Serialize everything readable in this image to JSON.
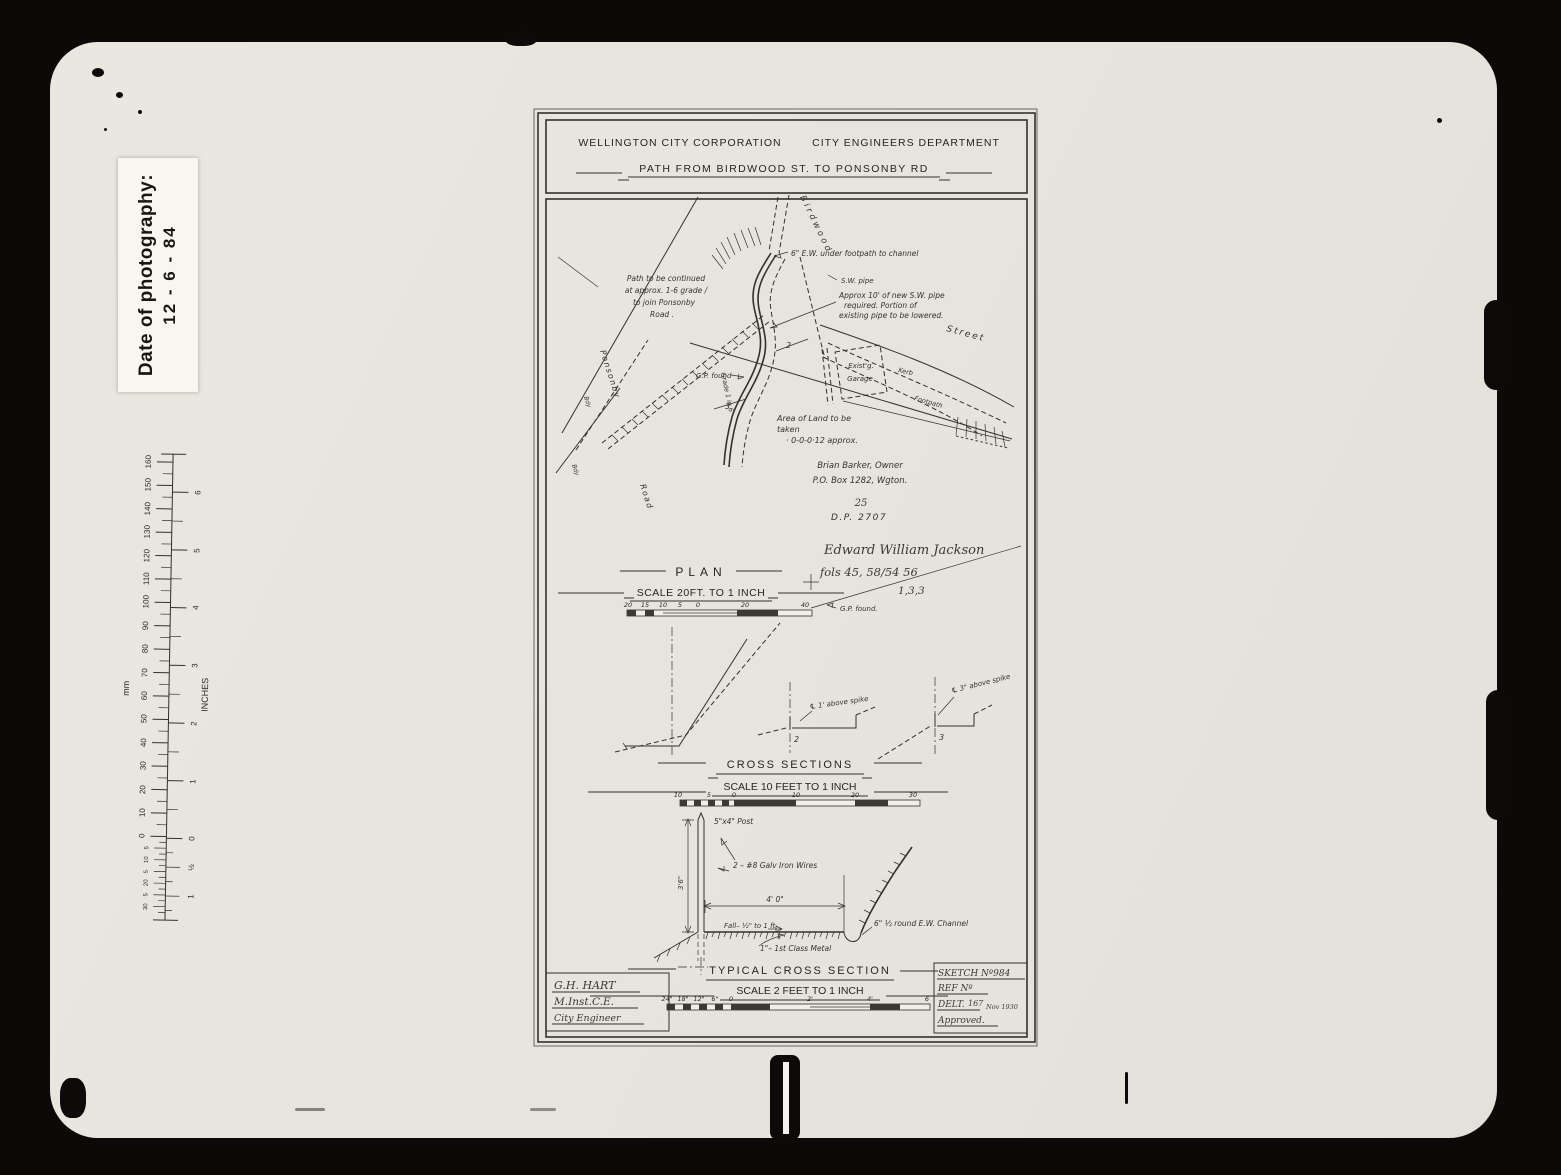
{
  "photo_label": {
    "title": "Date of photography:",
    "date": "12 - 6 - 84"
  },
  "ruler": {
    "unit_left": "mm",
    "unit_right": "INCHES",
    "mm": [
      "160",
      "150",
      "140",
      "130",
      "120",
      "110",
      "100",
      "90",
      "80",
      "70",
      "60",
      "50",
      "40",
      "30",
      "20",
      "10",
      "0"
    ],
    "mm_sub": [
      "5",
      "10",
      "5",
      "20",
      "5",
      "30"
    ],
    "inches": [
      "6",
      "5",
      "4",
      "3",
      "2",
      "1",
      "0"
    ],
    "inches_sub": [
      "½",
      "1"
    ]
  },
  "header": {
    "org": "WELLINGTON CITY CORPORATION",
    "dept": "CITY ENGINEERS DEPARTMENT",
    "title": "PATH FROM BIRDWOOD ST. TO PONSONBY RD"
  },
  "plan": {
    "title": "PLAN",
    "scale": "SCALE 20FT. TO 1 INCH",
    "ticks": [
      "20",
      "15",
      "10",
      "5",
      "0",
      "20",
      "40"
    ],
    "street_birdwood": "Birdwood",
    "street_label": "Street",
    "kerb": "Kerb",
    "footpath": "Footpath",
    "ponsonby": "Ponsonby",
    "road": "Road",
    "bdy1": "Bdy",
    "bdy2": "Bdy",
    "ew_note": "6\" E.W. under footpath to channel",
    "sw_pipe": "S.W. pipe",
    "pipe_note": [
      "Approx 10' of new S.W. pipe",
      "required.  Portion of",
      "existing pipe to be lowered."
    ],
    "path_note": [
      "Path to be continued",
      "at approx. 1-6 grade /",
      "to join Ponsonby",
      "Road ."
    ],
    "garage": [
      "Exist'g.",
      "Garage"
    ],
    "gp_found": "G.P. found",
    "grade": "Grade 1 in 6",
    "sec2": "2",
    "sec3": "3",
    "area_note": [
      "Area of Land to be",
      "taken",
      "· 0-0-0·12  approx."
    ],
    "owner": [
      "Brian  Barker, Owner",
      "P.O. Box 1282, Wgton."
    ],
    "lot": "25",
    "dp": "D.P. 2707",
    "hand": [
      "Edward William Jackson",
      "fols 45, 58/54 56",
      "1,3,3"
    ],
    "gp_found2": "G.P. found."
  },
  "cross_sections": {
    "title": "CROSS SECTIONS",
    "scale": "SCALE 10 FEET TO 1 INCH",
    "ticks": [
      "10",
      "5",
      "0",
      "10",
      "20",
      "30"
    ],
    "sec2": "2",
    "sec3": "3",
    "spike2": "℄ 1' above spike",
    "spike3": "℄ 3\" above spike"
  },
  "typical": {
    "title": "TYPICAL CROSS SECTION",
    "scale": "SCALE 2 FEET TO 1 INCH",
    "ticks": [
      "24\"",
      "18\"",
      "12\"",
      "6\"",
      "0",
      "2'",
      "4'",
      "6"
    ],
    "post": "5\"x4\" Post",
    "wires": "2 – #8 Galv Iron Wires",
    "height": "3'6\"",
    "width": "4' 0\"",
    "fall": "Fall– ½\" to 1 ft",
    "channel": "6\" ½ round E.W. Channel",
    "metal": "1\"– 1st Class Metal"
  },
  "engineer": {
    "name": "G.H. HART",
    "qual": "M.Inst.C.E.",
    "role": "City Engineer"
  },
  "sketch_block": {
    "sketch_no": "SKETCH Nº984",
    "ref_no": "REF Nº",
    "delt": "DELT.",
    "delt_no": "167",
    "date": "Nov 1930",
    "approved": "Approved."
  }
}
